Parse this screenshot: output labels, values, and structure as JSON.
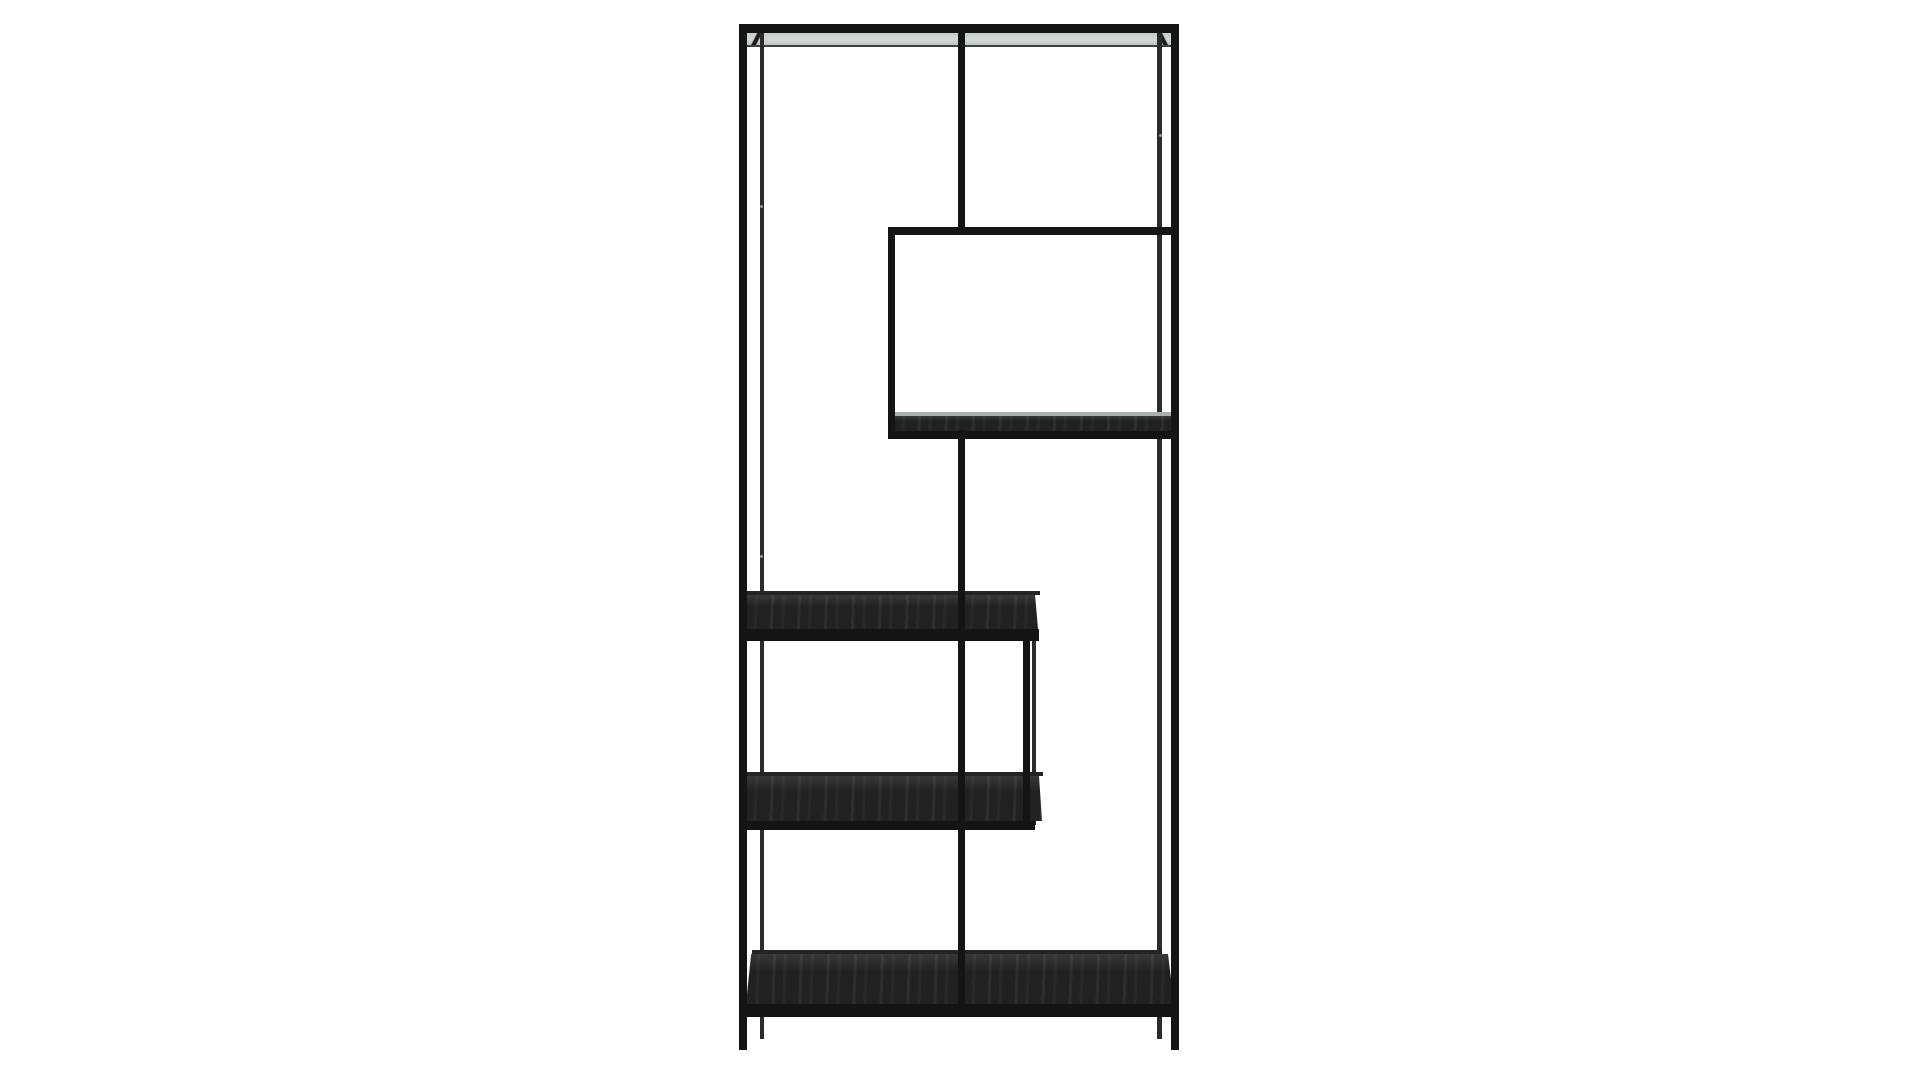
{
  "image": {
    "kind": "studio product photograph",
    "background": "#ffffff",
    "subject": "tall black metal asymmetric shelving unit with staggered open shelves, photographed front-on against a plain white backdrop"
  },
  "product": {
    "category": "bookcase-shelving-unit",
    "finish": "matte black metal frame with black ash woodgrain shelf panels",
    "shelf_count": 5,
    "shelves": [
      "top shelf (full width, light panel sliver visible)",
      "upper-right box shelf",
      "middle-left shelf",
      "lower-left shelf",
      "bottom shelf (full width)"
    ],
    "supports": [
      "left side frame (front and back posts)",
      "right side frame (front and back posts)",
      "center vertical spine (upper segment and lower segment)",
      "box left upright",
      "lower-right upright"
    ],
    "details": [
      "three small screw heads visible on back posts"
    ]
  },
  "colors": {
    "background": "#ffffff",
    "metal": "#131414",
    "metal_back": "#2a2c2c",
    "back_bar": "#232525",
    "wood": "#202222",
    "top_panel": "#c6cccc",
    "panel_line": "#3d4141",
    "sheen": "#a9b0b0",
    "screw": "#919999"
  }
}
